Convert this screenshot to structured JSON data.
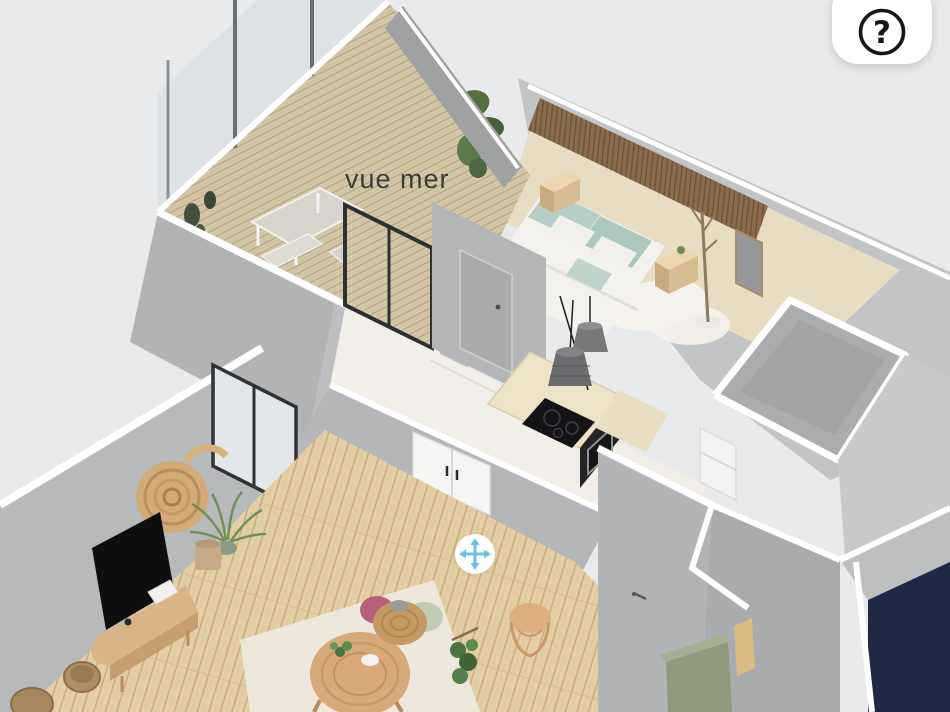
{
  "ui": {
    "help_button": {
      "icon": "help-question-icon",
      "glyph": "?"
    },
    "move_control": {
      "icon": "move-pan-icon"
    }
  },
  "scene": {
    "labels": {
      "terrace": "vue mer"
    },
    "colors": {
      "background": "#e9eaec",
      "wall_cap": "#ffffff",
      "wall_face": "#b2b4b6",
      "wall_face_light": "#c8c9cb",
      "wood_floor": "#e4cfa4",
      "deck_wood": "#d5c8a9",
      "tile_floor": "#f2efe9",
      "accent_blue": "#6fc0e0",
      "navy_panel": "#1f2946",
      "green_cabinet": "#8f9a7d",
      "sage_pillow": "#b5cec6",
      "slat_wall": "#8a6c4d",
      "tv_black": "#0e0e10",
      "rattan": "#c49a62"
    }
  }
}
